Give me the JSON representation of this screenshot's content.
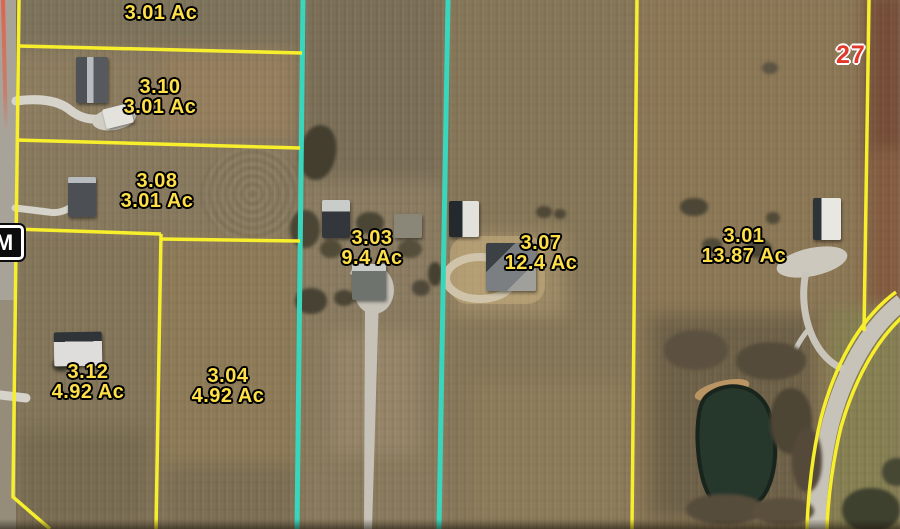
{
  "map": {
    "title": "Aerial parcel map",
    "route_marker": "M",
    "route_number": "27",
    "parcel_labels": [
      {
        "id": "3-01ac-top",
        "lines": [
          "3.01 Ac"
        ],
        "x": 161,
        "y": 13
      },
      {
        "id": "3-10",
        "lines": [
          "3.10",
          "3.01 Ac"
        ],
        "x": 160,
        "y": 97
      },
      {
        "id": "3-08",
        "lines": [
          "3.08",
          "3.01 Ac"
        ],
        "x": 157,
        "y": 191
      },
      {
        "id": "3-03",
        "lines": [
          "3.03",
          "9.4 Ac"
        ],
        "x": 372,
        "y": 248
      },
      {
        "id": "3-07",
        "lines": [
          "3.07",
          "12.4 Ac"
        ],
        "x": 541,
        "y": 253
      },
      {
        "id": "3-01",
        "lines": [
          "3.01",
          "13.87 Ac"
        ],
        "x": 744,
        "y": 246
      },
      {
        "id": "3-12",
        "lines": [
          "3.12",
          "4.92 Ac"
        ],
        "x": 88,
        "y": 382
      },
      {
        "id": "3-04",
        "lines": [
          "3.04",
          "4.92 Ac"
        ],
        "x": 228,
        "y": 386
      }
    ],
    "colors": {
      "parcel_line": "#f7ef2c",
      "highlight_line": "#38d7bd",
      "label_text": "#ffe049",
      "route_number_text": "#e03a2c",
      "marker_background": "#0c0c0c",
      "marker_text": "#ffffff",
      "road_edge_line": "#e2604b"
    }
  }
}
